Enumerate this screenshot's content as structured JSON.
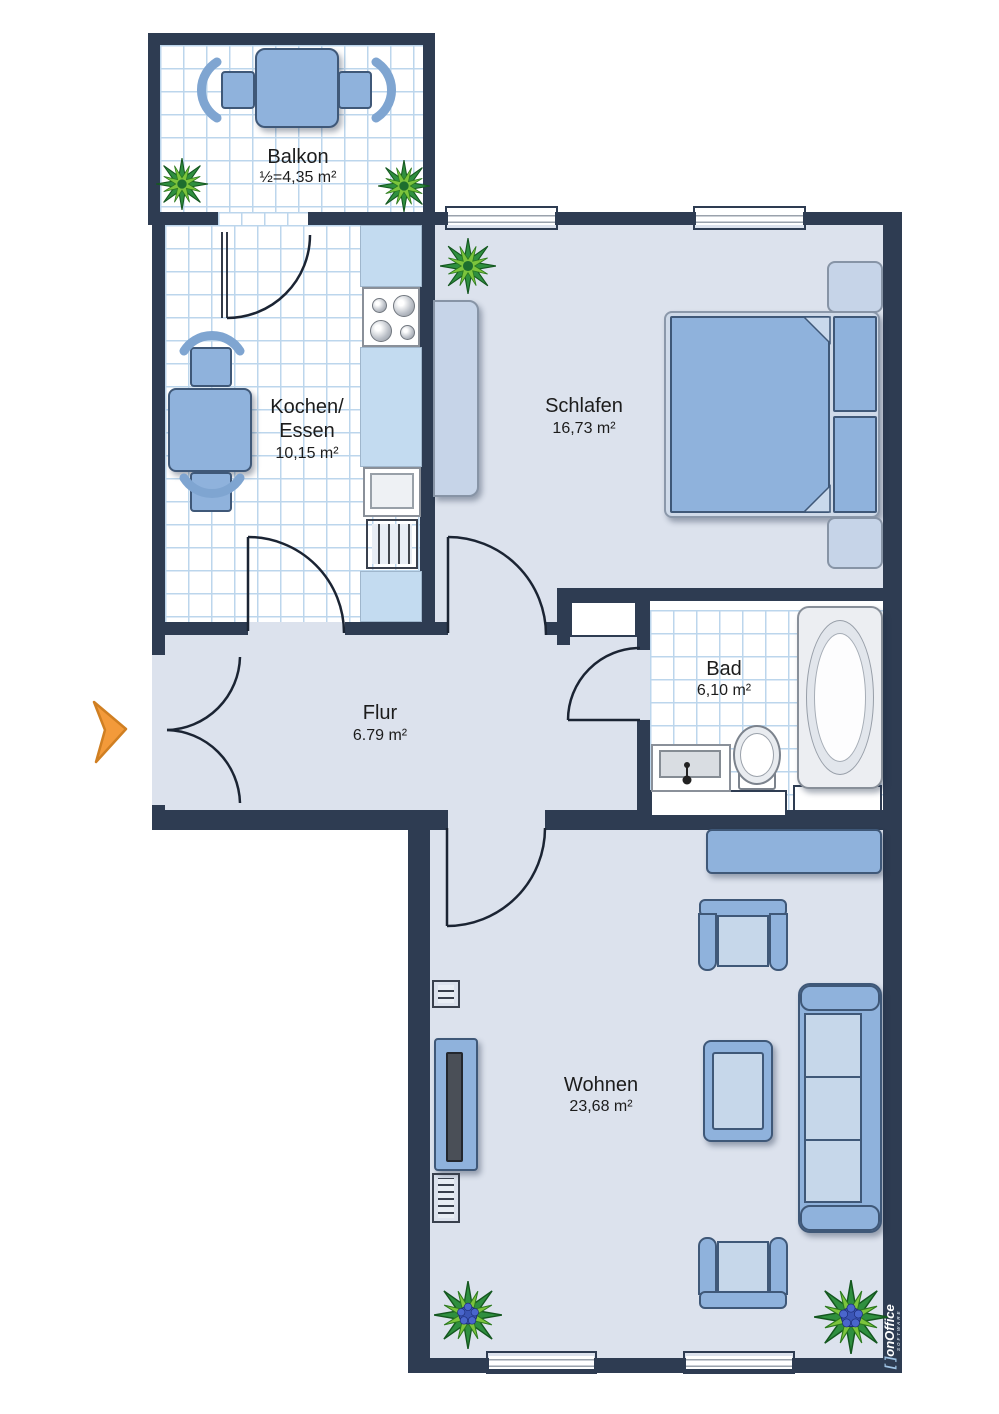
{
  "rooms": {
    "balkon": {
      "label": "Balkon",
      "area": "½=4,35 m²"
    },
    "kochen_essen": {
      "line1": "Kochen/",
      "line2": "Essen",
      "area": "10,15 m²"
    },
    "schlafen": {
      "label": "Schlafen",
      "area": "16,73 m²"
    },
    "flur": {
      "label": "Flur",
      "area": "6.79 m²"
    },
    "bad": {
      "label": "Bad",
      "area": "6,10 m²"
    },
    "wohnen": {
      "label": "Wohnen",
      "area": "23,68 m²"
    }
  },
  "branding": {
    "bracket": "[ ]",
    "name": "onOffice",
    "subtitle": "SOFTWARE"
  },
  "colors": {
    "wall": "#2e3c52",
    "floor": "#dce2ed",
    "tile_line": "#bcd6ec",
    "furniture": "#8fb2dc",
    "furniture_light": "#c6d7ea",
    "furniture_border": "#3f5878",
    "entrance_arrow": "#f39a3a",
    "plant_green": "#2f8f3f",
    "flower_blue": "#3b55b5",
    "logo_text": "#ffffff"
  }
}
